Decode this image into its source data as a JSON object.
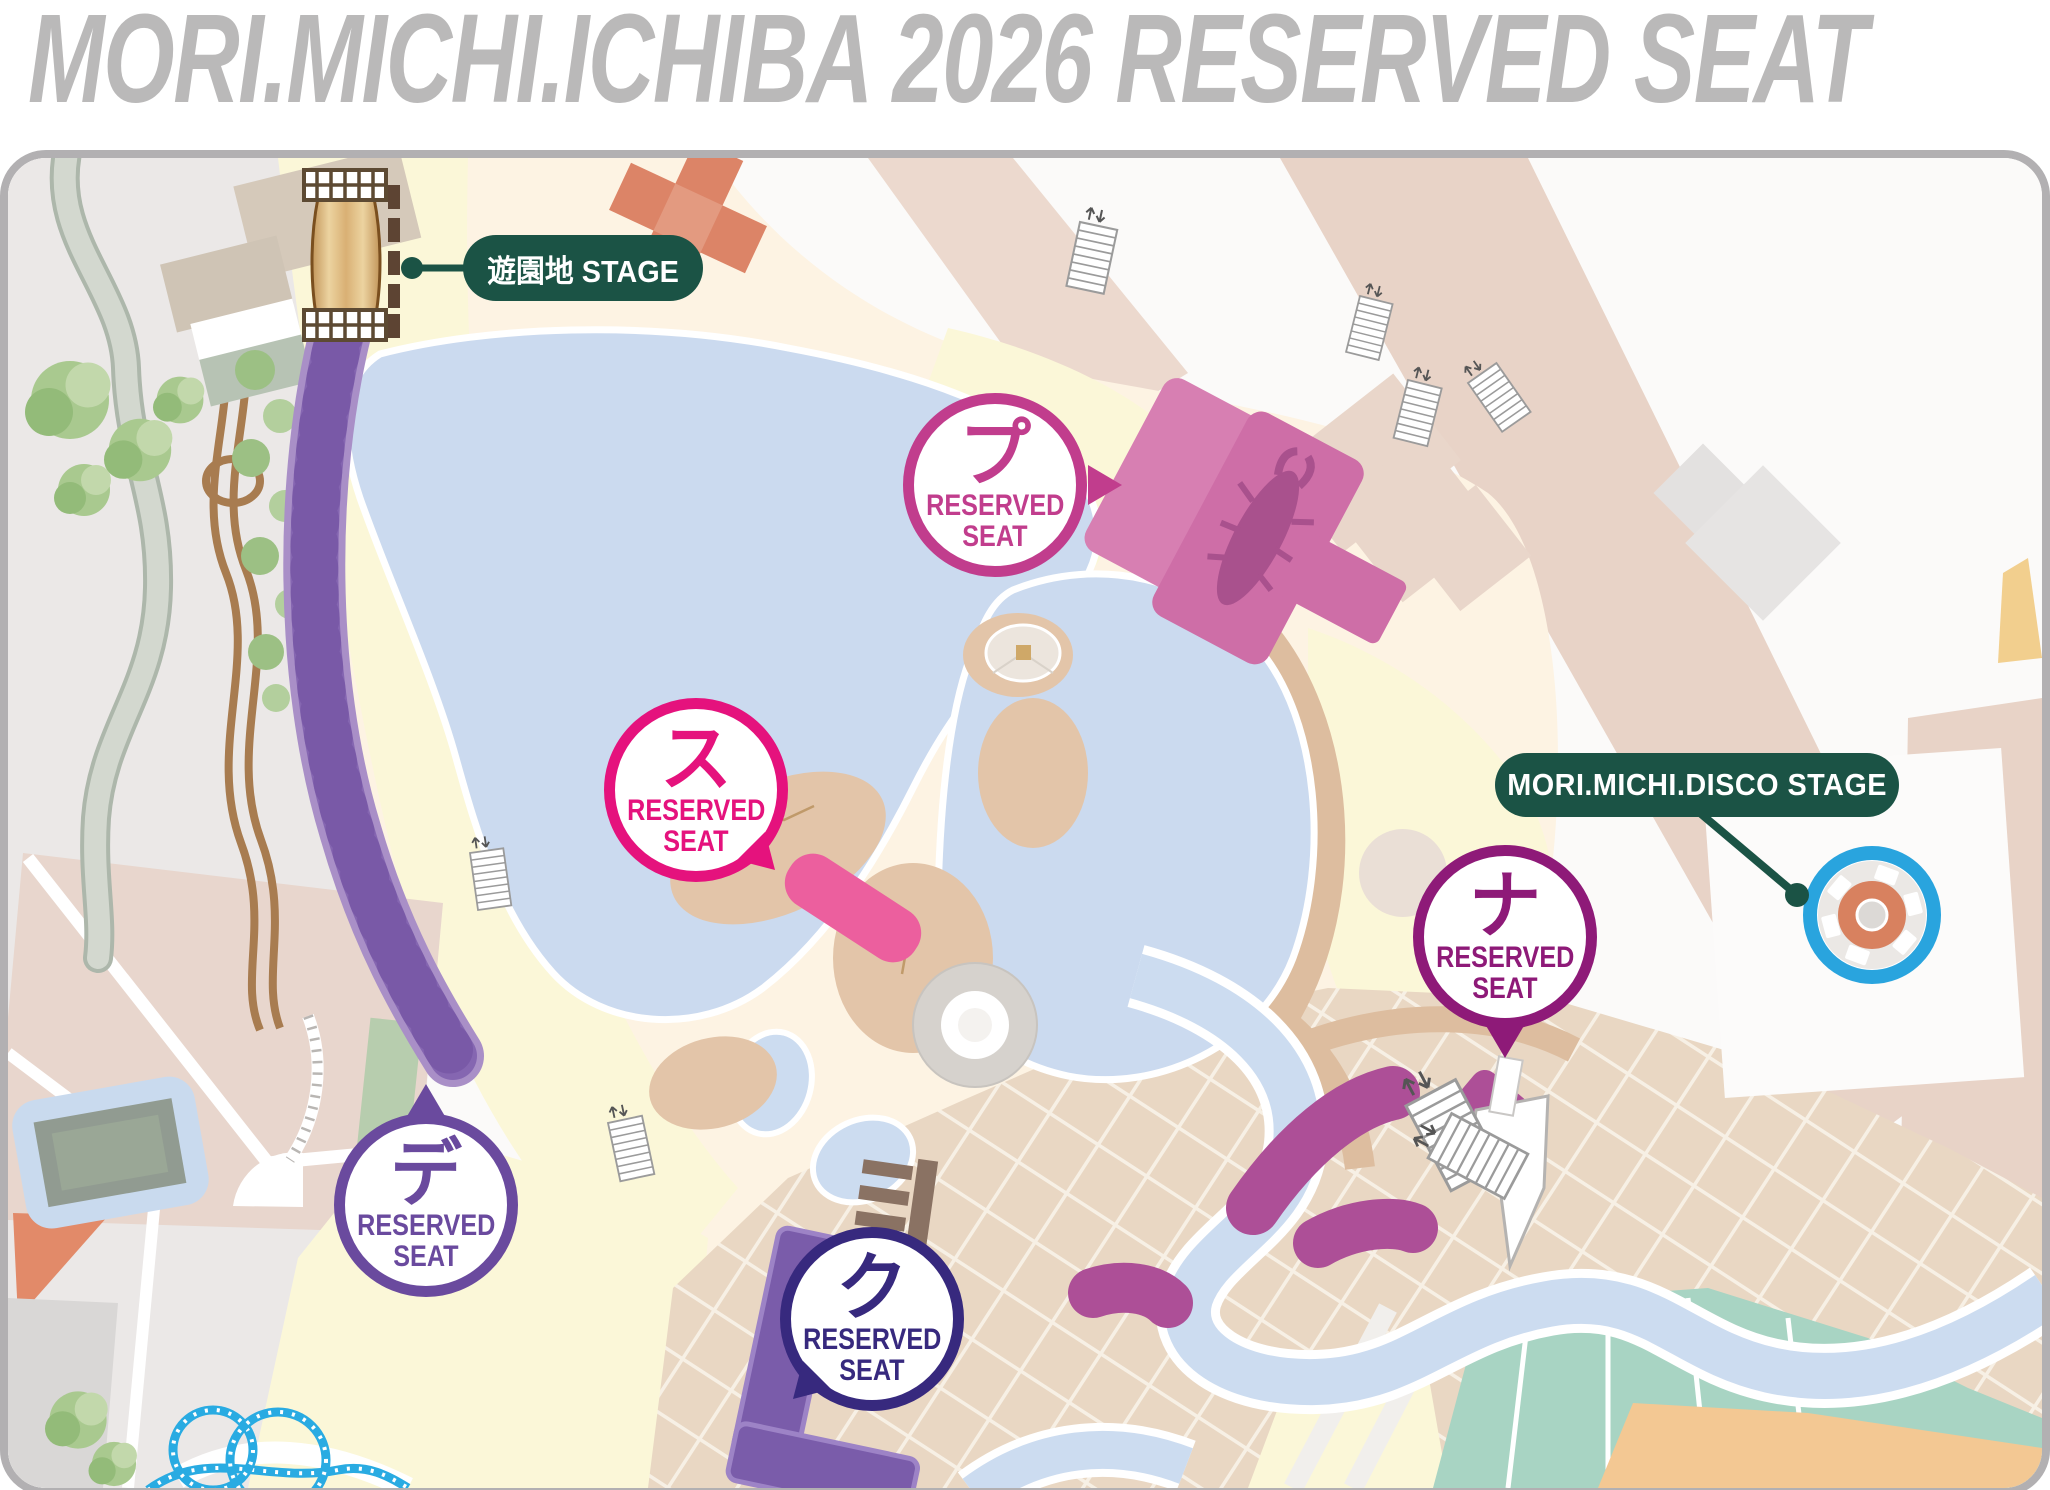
{
  "title": "MORI.MICHI.ICHIBA 2026 RESERVED SEAT",
  "stages": {
    "yuenchi": {
      "label": "遊園地 STAGE",
      "pill_color": "#1b5345",
      "text_color": "#ffffff"
    },
    "disco": {
      "label": "MORI.MICHI.DISCO STAGE",
      "pill_color": "#1b5345",
      "text_color": "#ffffff"
    }
  },
  "badges": {
    "pu": {
      "letter": "プ",
      "line1": "RESERVED",
      "line2": "SEAT",
      "color": "#c13d8d",
      "arrow_direction": "right"
    },
    "su": {
      "letter": "ス",
      "line1": "RESERVED",
      "line2": "SEAT",
      "color": "#e5127d",
      "arrow_direction": "down-right"
    },
    "na": {
      "letter": "ナ",
      "line1": "RESERVED",
      "line2": "SEAT",
      "color": "#8e1a78",
      "arrow_direction": "down"
    },
    "de": {
      "letter": "デ",
      "line1": "RESERVED",
      "line2": "SEAT",
      "color": "#6a4a9e",
      "arrow_direction": "up"
    },
    "ku": {
      "letter": "ク",
      "line1": "RESERVED",
      "line2": "SEAT",
      "color": "#37297e",
      "arrow_direction": "down-left"
    }
  },
  "map_colors": {
    "title_gray": "#bab9b9",
    "map_border_gray": "#b2b0b2",
    "water_blue": "#cbdaef",
    "beach_sand": "#ddbd9f",
    "cream_ground": "#fdf3e3",
    "path_yellow": "#fbf7d8",
    "plaza_tile": "#e9d7c3",
    "seat_arc_purple": "#8566b1",
    "seat_bar_pink": "#ec5f9e",
    "seat_block_indigo": "#7a5caa",
    "seat_river_magenta": "#ad4f97",
    "pu_stage_pink": "#d77fb2",
    "disco_ring_blue": "#29a4de",
    "disco_center_orange": "#d8815f",
    "stage_pill_green": "#1b5345",
    "amusement_stage_tan": "#d9b074",
    "roller_coaster_cyan": "#29abe2"
  }
}
